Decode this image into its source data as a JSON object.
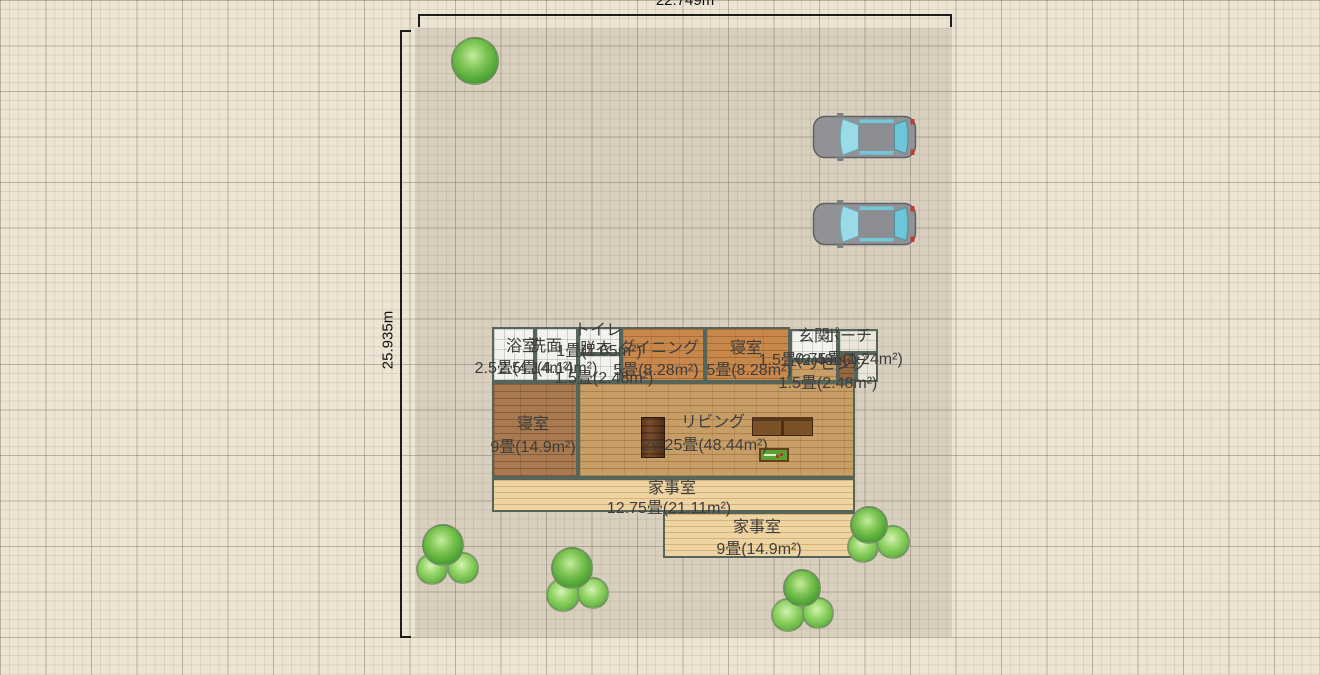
{
  "plan": {
    "dimensions": {
      "width_label": "22.749m",
      "height_label": "25.935m"
    },
    "rooms": [
      {
        "id": "bath",
        "name": "浴室",
        "size": "2.5畳(4.14m²)"
      },
      {
        "id": "washroom",
        "name": "洗面",
        "size": "2.5畳(4.14m²)"
      },
      {
        "id": "toilet",
        "name": "トイレ",
        "size": "1畳(1.65m²)"
      },
      {
        "id": "dressing",
        "name": "脱衣",
        "size": "1.5畳(2.48m²)"
      },
      {
        "id": "dining",
        "name": "ダイニング",
        "size": "5畳(8.28m²)"
      },
      {
        "id": "bedroom_top",
        "name": "寝室",
        "size": "5畳(8.28m²)"
      },
      {
        "id": "entrance",
        "name": "玄関",
        "size": "1.5畳(2.48m²)"
      },
      {
        "id": "porch",
        "name": "ポーチ",
        "size": "0.75畳(1.24m²)"
      },
      {
        "id": "living_small",
        "name": "リビング",
        "size": "1.5畳(2.48m²)"
      },
      {
        "id": "bedroom_left",
        "name": "寝室",
        "size": "9畳(14.9m²)"
      },
      {
        "id": "living",
        "name": "リビング",
        "size": "29.25畳(48.44m²)"
      },
      {
        "id": "utility_1",
        "name": "家事室",
        "size": "12.75畳(21.11m²)"
      },
      {
        "id": "utility_2",
        "name": "家事室",
        "size": "9畳(14.9m²)"
      }
    ],
    "objects": {
      "cars": 2,
      "trees": 5
    },
    "colors": {
      "canvas_bg": "#ede4d3",
      "parcel_tint": "#d6cfc1",
      "dimension_line": "#1c1c1c",
      "wall": "#56655a",
      "tile_floor": "#f3f3ee",
      "orange_plank_floor": "#c8874b",
      "brown_plank_floor": "#a97a50",
      "tan_brick_floor": "#c79e66",
      "light_plank_floor": "#eed4a2",
      "tree_green": "#46a02e",
      "car_body": "#909296",
      "car_glass": "#9adbe8",
      "label_text": "#3d3d3d"
    }
  }
}
